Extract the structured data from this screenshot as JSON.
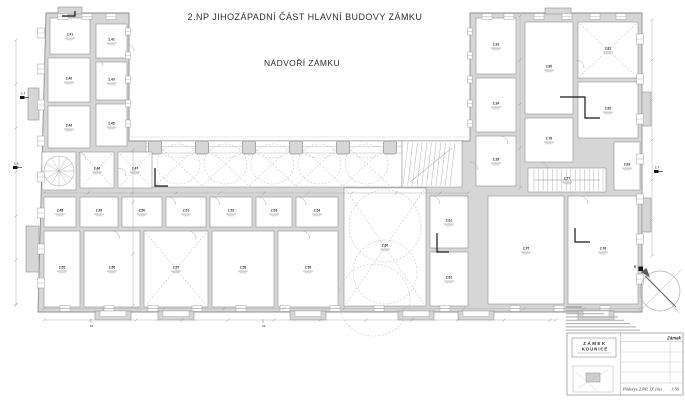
{
  "header": {
    "title": "2.NP JIHOZÁPADNÍ ČÁST HLAVNÍ BUDOVY ZÁMKU",
    "courtyard_label": "NÁDVOŘÍ ZÁMKU"
  },
  "colors": {
    "paper": "#ffffff",
    "wall_fill": "#d6d6d6",
    "wall_line": "#8f8f8f",
    "thin_line": "#a9a9a9",
    "dash_line": "#c3c3c3",
    "label": "#2e2e2e",
    "black": "#161616"
  },
  "north": {
    "label": "S"
  },
  "rooms": [
    {
      "label": "2.41",
      "x": 50,
      "y": 18,
      "w": 40,
      "h": 36
    },
    {
      "label": "2.42",
      "x": 96,
      "y": 24,
      "w": 31,
      "h": 34
    },
    {
      "label": "2.40",
      "x": 48,
      "y": 58,
      "w": 42,
      "h": 44
    },
    {
      "label": "2.43",
      "x": 96,
      "y": 62,
      "w": 31,
      "h": 38
    },
    {
      "label": "2.44",
      "x": 48,
      "y": 106,
      "w": 42,
      "h": 42
    },
    {
      "label": "2.45",
      "x": 96,
      "y": 104,
      "w": 31,
      "h": 42
    },
    {
      "label": "",
      "x": 42,
      "y": 152,
      "w": 34,
      "h": 38,
      "vault": "spiral"
    },
    {
      "label": "2.46",
      "x": 80,
      "y": 152,
      "w": 34,
      "h": 36,
      "vault": "x"
    },
    {
      "label": "2.47",
      "x": 118,
      "y": 152,
      "w": 34,
      "h": 36,
      "vault": "x"
    },
    {
      "label": "2.48",
      "x": 44,
      "y": 197,
      "w": 32,
      "h": 30
    },
    {
      "label": "2.49",
      "x": 80,
      "y": 197,
      "w": 38,
      "h": 30
    },
    {
      "label": "2.50",
      "x": 122,
      "y": 197,
      "w": 40,
      "h": 30
    },
    {
      "label": "2.51",
      "x": 166,
      "y": 197,
      "w": 40,
      "h": 30
    },
    {
      "label": "2.52",
      "x": 210,
      "y": 197,
      "w": 42,
      "h": 30
    },
    {
      "label": "2.53",
      "x": 256,
      "y": 197,
      "w": 36,
      "h": 30
    },
    {
      "label": "2.54",
      "x": 296,
      "y": 197,
      "w": 42,
      "h": 30
    },
    {
      "label": "2.55",
      "x": 44,
      "y": 231,
      "w": 36,
      "h": 76
    },
    {
      "label": "2.56",
      "x": 84,
      "y": 231,
      "w": 56,
      "h": 76
    },
    {
      "label": "2.57",
      "x": 144,
      "y": 231,
      "w": 64,
      "h": 76,
      "vault": "x"
    },
    {
      "label": "2.58",
      "x": 212,
      "y": 231,
      "w": 62,
      "h": 76
    },
    {
      "label": "2.59",
      "x": 278,
      "y": 231,
      "w": 60,
      "h": 76
    },
    {
      "label": "2.60",
      "x": 344,
      "y": 188,
      "w": 82,
      "h": 118,
      "vault": "circles"
    },
    {
      "label": "2.61",
      "x": 430,
      "y": 196,
      "w": 38,
      "h": 52
    },
    {
      "label": "2.62",
      "x": 430,
      "y": 252,
      "w": 38,
      "h": 54
    },
    {
      "label": "2.33",
      "x": 476,
      "y": 18,
      "w": 40,
      "h": 56
    },
    {
      "label": "2.34",
      "x": 476,
      "y": 78,
      "w": 40,
      "h": 54
    },
    {
      "label": "2.35",
      "x": 476,
      "y": 136,
      "w": 40,
      "h": 50
    },
    {
      "label": "2.80",
      "x": 525,
      "y": 22,
      "w": 48,
      "h": 92
    },
    {
      "label": "2.81",
      "x": 578,
      "y": 22,
      "w": 60,
      "h": 56,
      "vault": "x"
    },
    {
      "label": "2.82",
      "x": 578,
      "y": 82,
      "w": 60,
      "h": 56
    },
    {
      "label": "2.78",
      "x": 525,
      "y": 118,
      "w": 48,
      "h": 44
    },
    {
      "label": "2.77",
      "x": 528,
      "y": 168,
      "w": 78,
      "h": 24,
      "stairs": "h"
    },
    {
      "label": "2.75",
      "x": 488,
      "y": 196,
      "w": 76,
      "h": 108
    },
    {
      "label": "2.76",
      "x": 568,
      "y": 196,
      "w": 70,
      "h": 108
    },
    {
      "label": "2.83",
      "x": 614,
      "y": 142,
      "w": 26,
      "h": 48
    }
  ],
  "pillars": {
    "y": 141,
    "size": 13,
    "xs": [
      155,
      202,
      249,
      296,
      343,
      390
    ]
  },
  "axis_markers": [
    {
      "label": "1.7",
      "x": 20,
      "y": 96
    },
    {
      "label": "1.A",
      "x": 13,
      "y": 166
    },
    {
      "label": "1.7",
      "x": 654,
      "y": 170
    }
  ],
  "tick_labels": [
    {
      "text": "b2",
      "x": 90,
      "y": 327
    },
    {
      "text": "b2",
      "x": 262,
      "y": 327
    }
  ],
  "title_block": {
    "logo_line1": "ZÁMEK",
    "logo_line2": "KOUNICE",
    "project_label": "Zámek",
    "drawing_name": "Půdorys 2.NP, JZ část",
    "scale": "1:50"
  }
}
